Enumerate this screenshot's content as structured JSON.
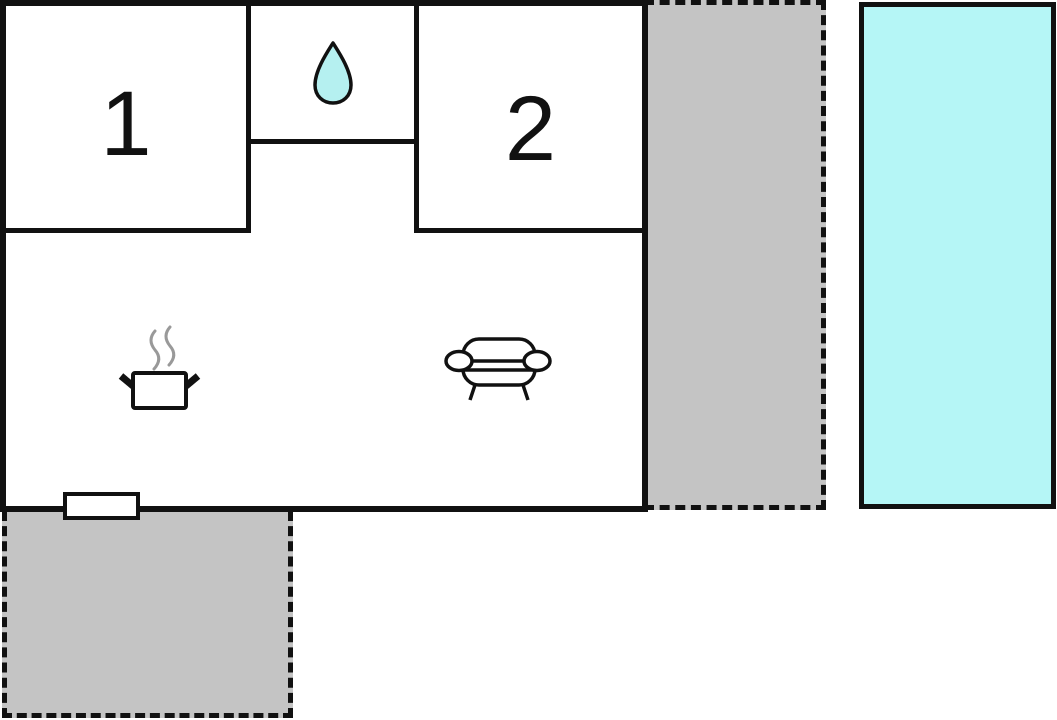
{
  "floorplan": {
    "rooms": [
      {
        "id": "bedroom-1",
        "label": "1"
      },
      {
        "id": "bathroom",
        "label": "",
        "icon": "water-drop-icon"
      },
      {
        "id": "bedroom-2",
        "label": "2"
      },
      {
        "id": "kitchen-living",
        "label": "",
        "icons": [
          "cooking-pot-icon",
          "sofa-icon"
        ]
      }
    ],
    "features": [
      {
        "id": "entrance-door"
      }
    ],
    "outdoor_areas": [
      {
        "id": "terrace-right",
        "style": "dashed-gray"
      },
      {
        "id": "terrace-bottom-left",
        "style": "dashed-gray"
      },
      {
        "id": "pool",
        "style": "water"
      }
    ],
    "colors": {
      "wall": "#111111",
      "terrace_fill": "#c4c4c4",
      "pool_fill": "#b5f6f6",
      "drop_fill": "#b5f0f0",
      "steam": "#999999",
      "background": "#ffffff"
    }
  }
}
